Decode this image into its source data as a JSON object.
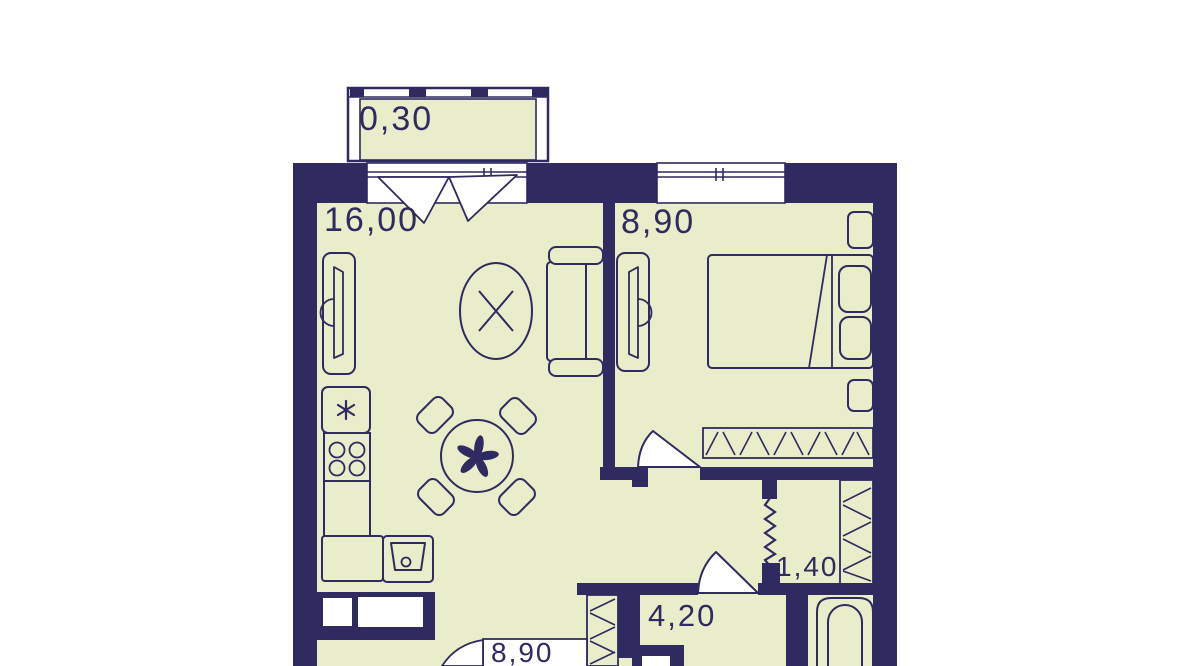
{
  "floorplan": {
    "type": "apartment-floor-plan",
    "colors": {
      "wall": "#2f2a5f",
      "floor": "#e9edc9",
      "background": "#ffffff",
      "outline": "#2f2a5f",
      "opening": "#ffffff"
    },
    "rooms": [
      {
        "name": "balcony",
        "area_label": "0,30"
      },
      {
        "name": "living-kitchen",
        "area_label": "16,00"
      },
      {
        "name": "bedroom",
        "area_label": "8,90"
      },
      {
        "name": "wardrobe-niche",
        "area_label": "1,40"
      },
      {
        "name": "hallway",
        "area_label": "4,20"
      },
      {
        "name": "adjacent-room",
        "area_label": "8,90"
      }
    ],
    "icons": {
      "fridge": "snowflake-asterisk",
      "stove": "four-burners",
      "sink": "basin-with-drain",
      "dining-table": "round-table-flower",
      "ceiling-lamp": "oval-with-cross",
      "bath": "bathtub",
      "wardrobes": "diagonal-hatch-strips",
      "doors": "quarter-circle-swings",
      "partition": "zigzag-line"
    }
  }
}
